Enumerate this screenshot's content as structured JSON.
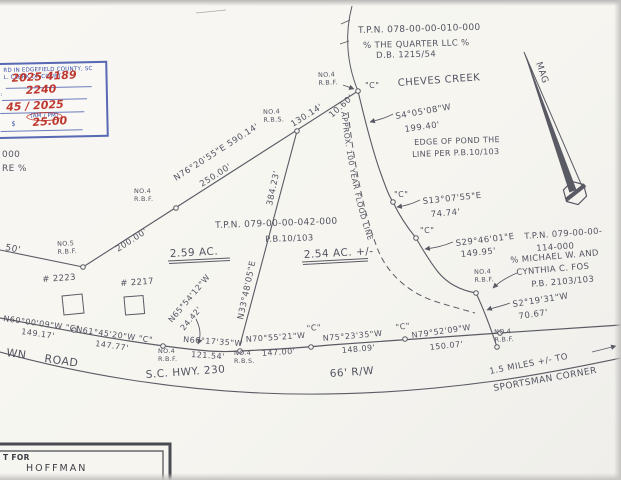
{
  "stamp": {
    "line1": "RD IN EDGEFIELD COUNTY, SC",
    "line2": "L. CLERK OF COURT",
    "instrument": "2025  4189",
    "time": "2240",
    "left_label": "ME:",
    "date": "45 / 2025",
    "ampm": "(AM / PM)",
    "fee_label": "$",
    "fee": "25.00"
  },
  "parcels": {
    "north_tpn": "T.P.N. 078-00-00-010-000",
    "north_owner": "% THE QUARTER LLC %",
    "north_deed": "D.B. 1215/54",
    "subject_tpn": "T.P.N. 079-00-00-042-000",
    "subject_pb": "P.B.10/103",
    "subject_area_a": "2.59 AC.",
    "subject_area_b": "2.54 AC. +/-",
    "east_tpn1": "T.P.N. 079-00-00-",
    "east_tpn2": "114-000",
    "east_owner1": "% MICHAEL W. AND",
    "east_owner2": "CYNTHIA C. FOS",
    "east_pb": "P.B. 2103/103",
    "west_cut1": "000",
    "west_cut2": "RE %"
  },
  "features": {
    "creek": "CHEVES CREEK",
    "pond1": "EDGE OF POND THE",
    "pond2": "LINE PER P.B.10/103",
    "flood": "APPROX.  100  YEAR  FLOOD  LINE",
    "mag": "MAG"
  },
  "bearings": {
    "n76": "N76°20'55\"E  590.14'",
    "d250": "250.00'",
    "d200": "200.00'",
    "d130": "130.14'",
    "d10": "10.60'",
    "n33": "N33°48'05\"E",
    "n33d": "384.23'",
    "w50": "50'",
    "s4": "S4°05'08\"W",
    "s4d": "199.40'",
    "s13": "S13°07'55\"E",
    "s13d": "74.74'",
    "s29": "S29°46'01\"E",
    "s29d": "149.95'",
    "s2": "S2°19'31\"W",
    "s2d": "70.67'",
    "n60": "N60°00'09\"W \"C\"",
    "n60d": "149.17'",
    "n61": "N61°45'20\"W \"C\"",
    "n61d": "147.77'",
    "n65": "N65°54'12\"W",
    "n65d": "24.42'",
    "n66": "N66°17'35\"W",
    "n66d": "121.54'",
    "n70": "N70°55'21\"W",
    "n70d": "147.00'",
    "n75": "N75°23'35\"W",
    "n75d": "148.09'",
    "n79": "N79°52'09\"W",
    "n79d": "150.07'"
  },
  "markers": {
    "no4_rbf": "NO.4\nR.B.F.",
    "no4_rbs": "NO.4\nR.B.S.",
    "no5_rbf": "NO.5\nR.B.F.",
    "c": "\"C\""
  },
  "road": {
    "name1": "WN",
    "name2": "ROAD",
    "hwy": "S.C. HWY. 230",
    "rw": "66' R/W",
    "miles": "1.5 MILES +/- TO",
    "corner": "SPORTSMAN CORNER"
  },
  "houses": {
    "h1": "# 2223",
    "h2": "# 2217"
  },
  "title_block": {
    "line1": "T FOR",
    "line2": "HOFFMAN"
  }
}
